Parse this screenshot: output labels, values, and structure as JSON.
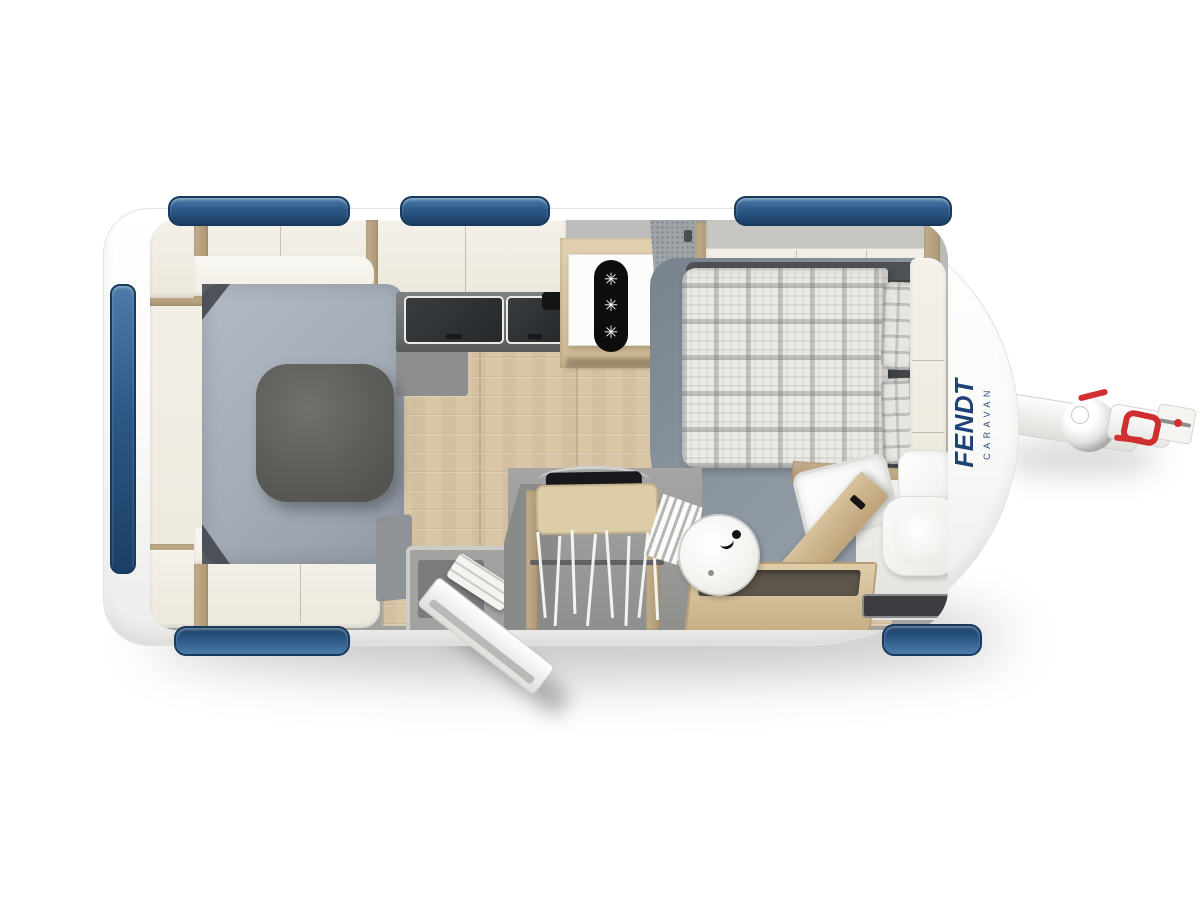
{
  "logo": {
    "brand": "FENDT",
    "subtitle": "CARAVAN"
  },
  "icons": {
    "snowflake": "✳"
  },
  "colors": {
    "body_white": "#f8f8f6",
    "window_blue": "#2c5886",
    "window_blue_dark": "#1b3f66",
    "logo_blue": "#1d4076",
    "accent_red": "#d23030",
    "upholstery_gray": "#a9b0bb",
    "furniture_cream": "#efebe1",
    "wood_floor": "#d8c6a7",
    "counter_gray": "#6f7173",
    "bed_platform_gray": "#8b95a0"
  }
}
